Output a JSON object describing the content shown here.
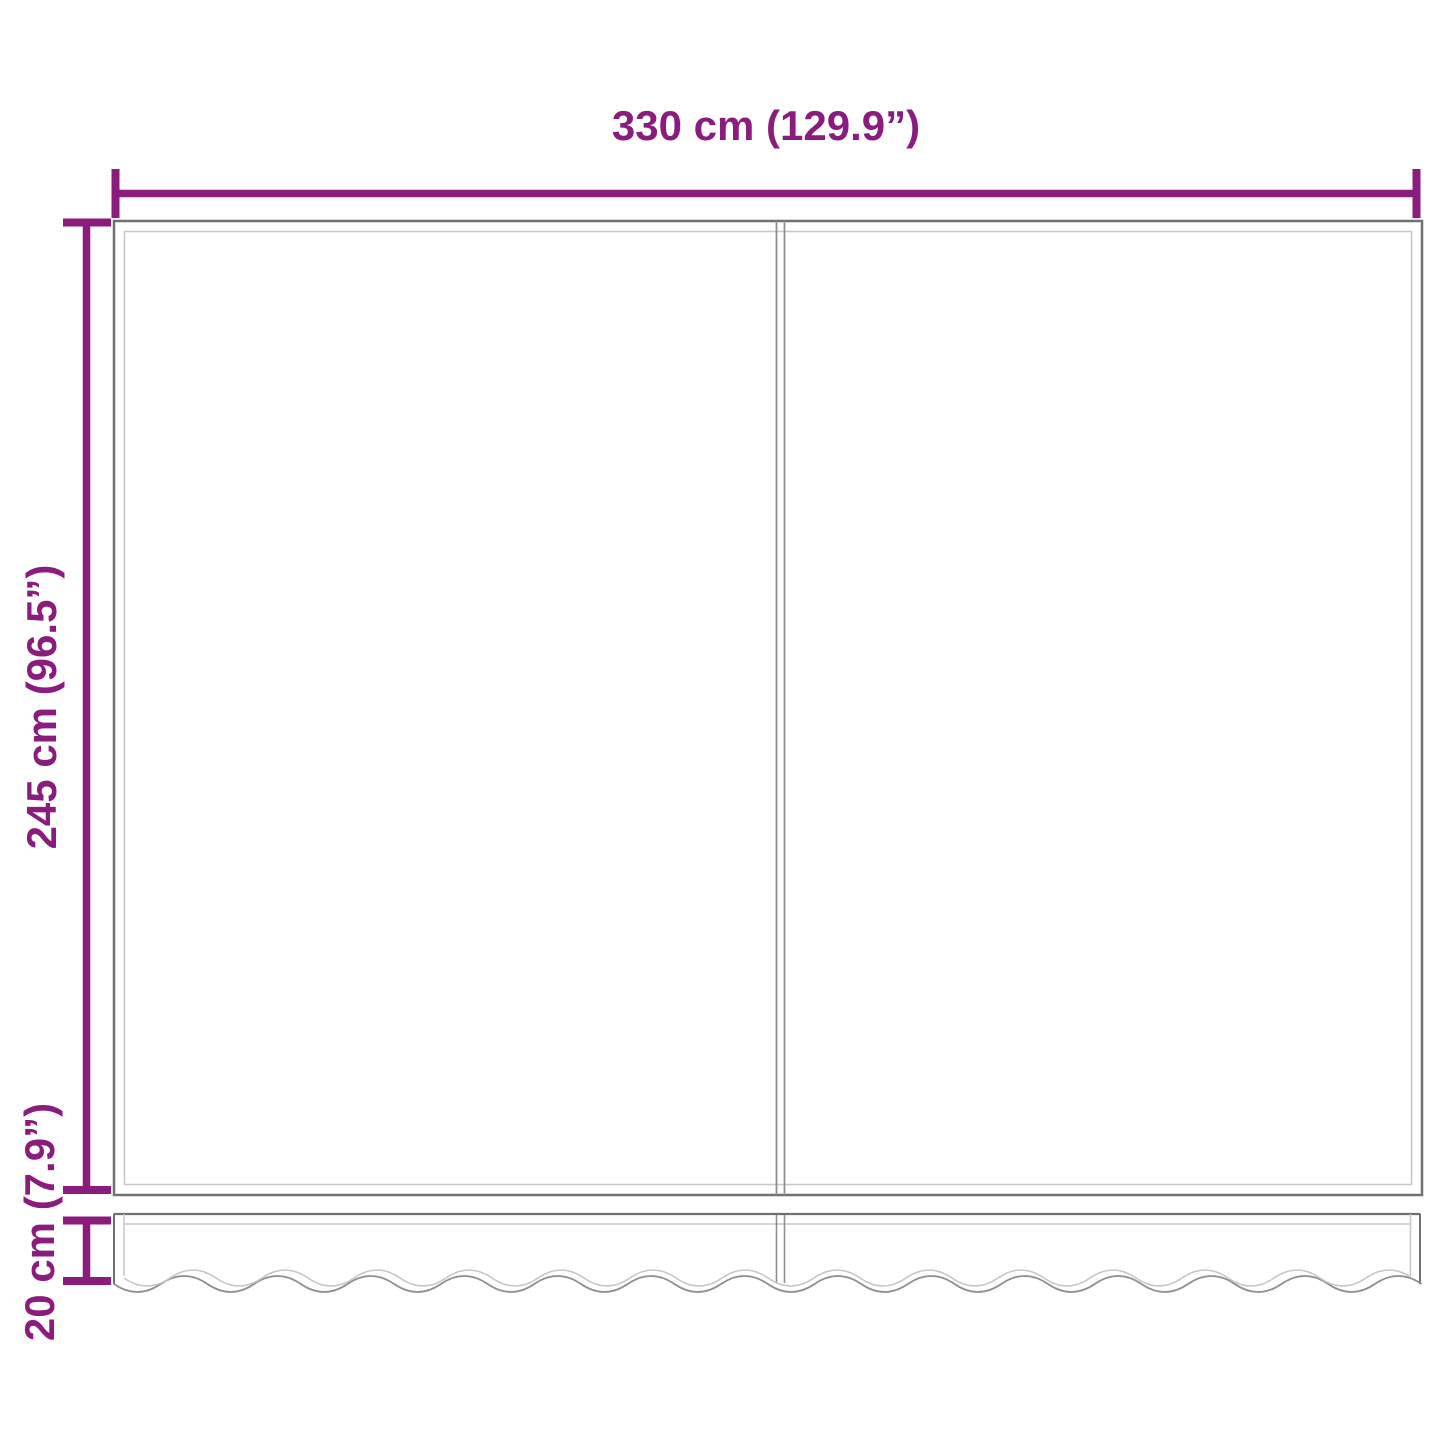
{
  "diagram": {
    "title": "awning-fabric-dimension-diagram",
    "width_label": "330 cm (129.9”)",
    "height_label": "245 cm (96.5”)",
    "valance_label": "20 cm (7.9”)"
  },
  "colors": {
    "accent": "#8A1C7E",
    "line_dark": "#707070",
    "line_mid": "#8F8F8F",
    "line_light": "#C6C6C6",
    "background": "#FFFFFF"
  }
}
